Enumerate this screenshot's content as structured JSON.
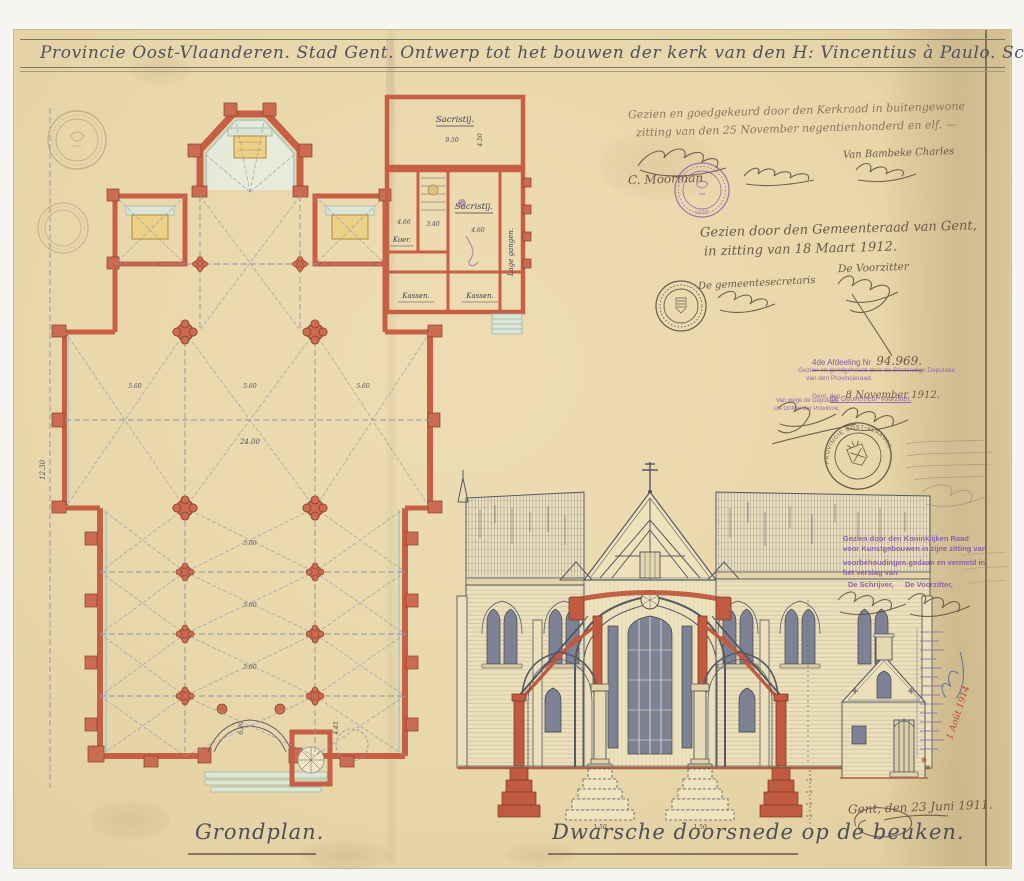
{
  "colors": {
    "paper": "#e8d7aa",
    "wall_red": "#c75f45",
    "trim_green": "#b5cdbf",
    "altar_yellow": "#ecd086",
    "drawing_ink": "#565a66",
    "hand_ink": "#6b5a48",
    "stamp_purple": "#8557a8",
    "red_ink": "#c0452f",
    "blue_ink": "#4a6a9a"
  },
  "title": {
    "text": "Provincie Oost-Vlaanderen.  Stad Gent.  Ontwerp tot het bouwen der kerk van den H: Vincentius à Paulo.  Schaal 1%."
  },
  "plan": {
    "caption": "Grondplan.",
    "dim_labels": [
      "5.60",
      "5.60",
      "5.60",
      "24.00",
      "5.60",
      "5.60",
      "5.60",
      "12.30",
      "6.90",
      "4.45"
    ],
    "annex": {
      "sacristy_top": "Sacristij.",
      "sacristy_top_w": "9.50",
      "sacristy_top_d": "4.50",
      "sacristy_main": "Sacristij.",
      "sacristy_main_w": "4.60",
      "koer": "Koer.",
      "koer_w": "4.66",
      "corridor": "Lage gangen.",
      "kassen_left": "Kassen.",
      "kassen_right": "Kassen.",
      "stair_dim": "3.40"
    }
  },
  "section": {
    "caption": "Dwarsche doorsnede op de beuken.",
    "footing_dims": [
      "1.50",
      "1.50"
    ]
  },
  "annotations": {
    "kerkraad": {
      "line1": "Gezien en goedgekeurd door den Kerkraad in buitengewone",
      "line2": "zitting van den 25 November negentienhonderd en elf. —",
      "sig_left": "C. Moorman",
      "sig_right": "Van Bambeke Charles"
    },
    "gemeenteraad": {
      "line1": "Gezien door den Gemeenteraad van Gent,",
      "line2": "in zitting van 18 Maart 1912.",
      "secretary": "De gemeentesecretaris",
      "chairman": "De Voorzitter"
    },
    "deputatie": {
      "heading": "4de Afdeeling Nr",
      "number": "94.969.",
      "line1": "Gezien en goedgekeurd door de Bestendige Deputatie",
      "line2": "van den Provincieraad.",
      "date_prefix": "Gent, den",
      "date": "8 November 1912.",
      "chairman": "De Gouverneur-Voorzitter,",
      "left1": "Van wege de Deputatie:",
      "left2": "De Griffier der Provincie;"
    },
    "koninklijke_raad": {
      "line1": "Gezien door den Koninklijken Raad",
      "line2": "voor Kunstgebouwen in zijne zitting van",
      "line3": "voorbehoudingen gedaan en vermeld in",
      "line4": "het verslag van",
      "schrijver": "De Schrijver,",
      "voorzitter": "De Voorzitter,"
    },
    "margin_note": {
      "red_date": "1 Août 1914"
    },
    "dated": {
      "text": "Gent, den 23 Juni 1911."
    }
  },
  "stamps": {
    "provincie_text": "PROVINCIE OOST-VLAANDEREN",
    "church_city": "GENT"
  }
}
